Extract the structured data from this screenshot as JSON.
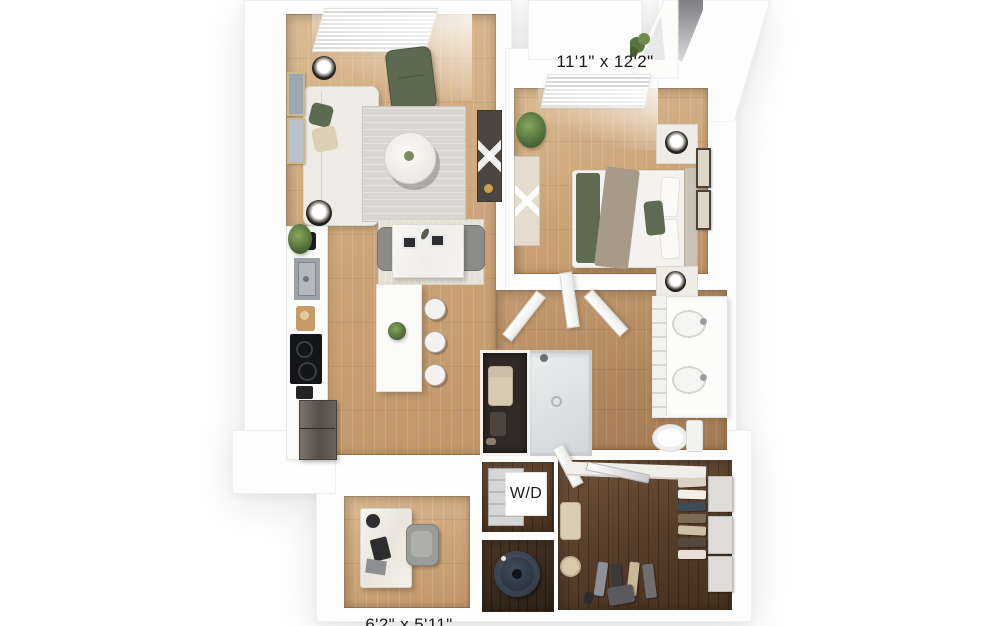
{
  "floorplan": {
    "labels": {
      "bedroom_dimensions": "11'1\" x 12'2\"",
      "washer_dryer": "W/D",
      "office_dimensions": "6'2\" x 5'11\""
    },
    "colors": {
      "background": "#ffffff",
      "wall": "#fdfdfd",
      "floor_light_wood": "#cba378",
      "floor_mid_wood": "#ae845b",
      "floor_dark_wood": "#533b28",
      "rug_gray": "#d8d6d1",
      "accent_olive": "#5d6a52",
      "label_text": "#1b1b1b"
    }
  }
}
